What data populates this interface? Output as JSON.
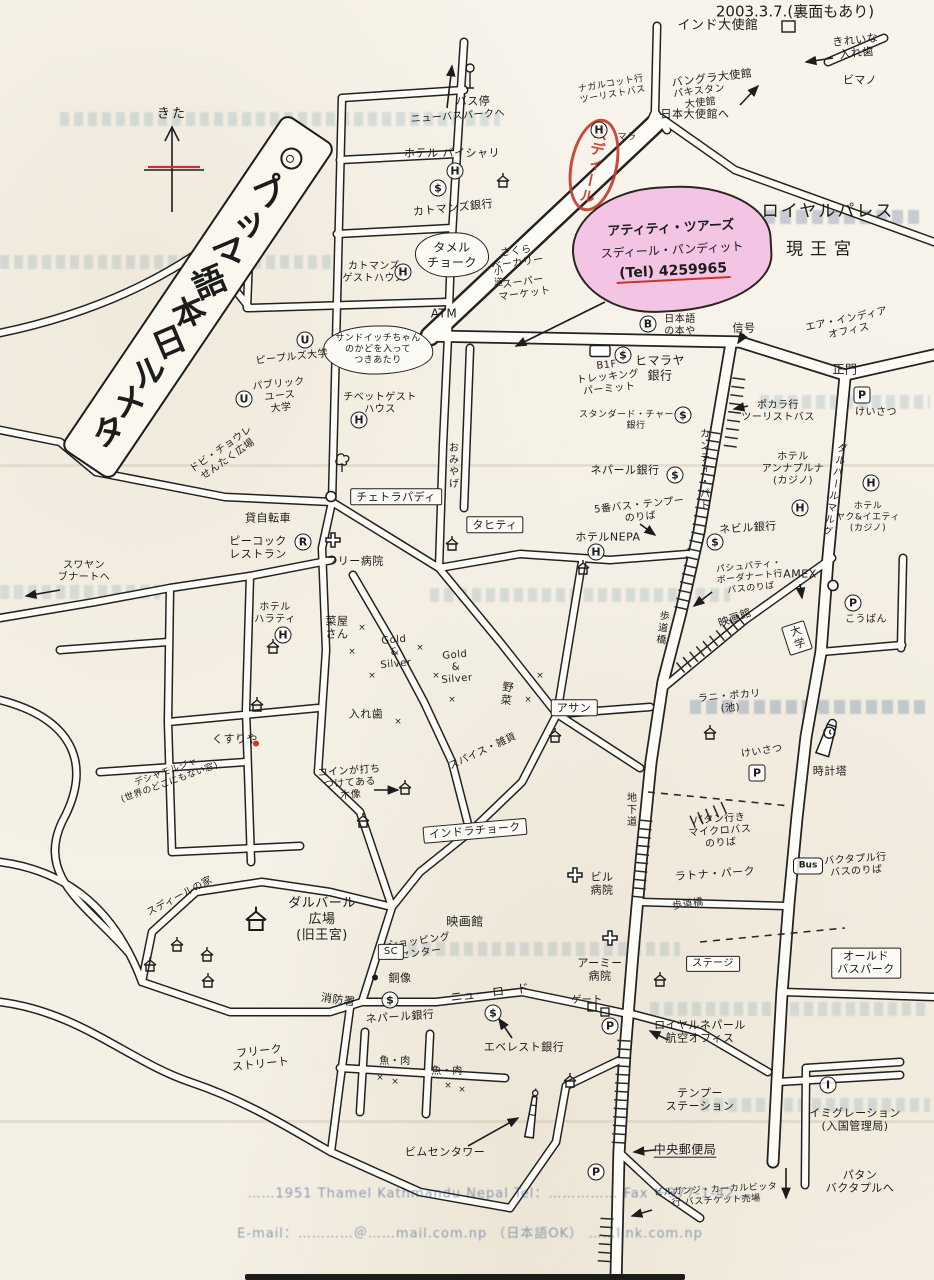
{
  "title": "タメル日本語マップ",
  "date_note": "2003.3.7.(裏面もあり)",
  "compass": {
    "label": "きた"
  },
  "stamp": {
    "text": "スディール",
    "color": "#c5372c"
  },
  "tour_office": {
    "name": "アティティ・ツアーズ",
    "person": "スディール・パンディット",
    "tel": "(Tel) 4259965",
    "highlight": "#f3c4e3"
  },
  "palace": {
    "name": "ロイヤルパレス",
    "subtitle": "現王宮"
  },
  "footer": {
    "line1": "……1951 Thamel Kathmandu Nepal  Tel：……………  Fax ＋977-1-42……",
    "line2": "E-mail：…………＠……mail.com.np （日本語OK） ……link.com.np"
  },
  "colors": {
    "ink": "#1c1c1c",
    "paper": "#f8f4ec",
    "pink": "#f3c4e3",
    "red": "#c5372c",
    "bleed": "#488096"
  },
  "legend_badges": {
    "H": "ホテル",
    "$": "銀行",
    "U": "大学",
    "B": "本や",
    "R": "レストラン",
    "P": "けいさつ",
    "I": "イミグレーション",
    "Bus": "バスのりば"
  },
  "labels": [
    {
      "t": "インド大使館",
      "x": 718,
      "y": 26,
      "s": 13
    },
    {
      "t": "きれいな\n入れ歯",
      "x": 856,
      "y": 47,
      "s": 11,
      "r": -6
    },
    {
      "t": "ビマノ",
      "x": 860,
      "y": 80,
      "s": 11
    },
    {
      "t": "バングラ大使館",
      "x": 712,
      "y": 78,
      "s": 11,
      "r": -7
    },
    {
      "t": "パキスタン\n大使館",
      "x": 700,
      "y": 98,
      "s": 10,
      "r": -7
    },
    {
      "t": "日本大使館へ",
      "x": 695,
      "y": 114,
      "s": 11
    },
    {
      "t": "ナガルコット行\nツーリストバス",
      "x": 612,
      "y": 90,
      "s": 9,
      "r": -10
    },
    {
      "t": "バス停",
      "x": 473,
      "y": 101,
      "s": 11
    },
    {
      "t": "ニューバスパークへ",
      "x": 458,
      "y": 117,
      "s": 10,
      "r": -4
    },
    {
      "t": "ホテル バイシャリ",
      "x": 452,
      "y": 153,
      "s": 11
    },
    {
      "t": "マラ",
      "x": 627,
      "y": 138,
      "s": 9
    },
    {
      "t": "カトマンズ銀行",
      "x": 453,
      "y": 208,
      "s": 11,
      "r": -6
    },
    {
      "t": "タメル\nチョーク",
      "x": 452,
      "y": 255,
      "s": 12,
      "cloud": true
    },
    {
      "t": "カトマンズ\nゲストハウス",
      "x": 374,
      "y": 273,
      "s": 10
    },
    {
      "t": "さくら\nベーカリー",
      "x": 517,
      "y": 258,
      "s": 10,
      "r": -8
    },
    {
      "t": "小道",
      "x": 496,
      "y": 277,
      "s": 9,
      "v": true
    },
    {
      "t": "スーパー\nマーケット",
      "x": 524,
      "y": 289,
      "s": 10,
      "r": -8
    },
    {
      "t": "ATM",
      "x": 444,
      "y": 314,
      "s": 12
    },
    {
      "t": "サンドイッチちゃん\nのかどを入って\nつきあたり",
      "x": 378,
      "y": 350,
      "s": 9,
      "cloud": true
    },
    {
      "t": "ピープルズ大学",
      "x": 292,
      "y": 358,
      "s": 10,
      "r": -6
    },
    {
      "t": "パブリック\nユース\n大学",
      "x": 280,
      "y": 397,
      "s": 10,
      "r": -6
    },
    {
      "t": "チベットゲスト\nハウス",
      "x": 380,
      "y": 404,
      "s": 10
    },
    {
      "t": "ドビ・チョウレ\nせんたく広場",
      "x": 225,
      "y": 455,
      "s": 10,
      "r": -35
    },
    {
      "t": "B1F\nトレッキング\nパーミット",
      "x": 608,
      "y": 378,
      "s": 10,
      "r": -6
    },
    {
      "t": "ヒマラヤ\n銀行",
      "x": 660,
      "y": 368,
      "s": 12
    },
    {
      "t": "スタンダード・チャーター\n銀行",
      "x": 636,
      "y": 421,
      "s": 9
    },
    {
      "t": "ポカラ行\nツーリストバス",
      "x": 778,
      "y": 412,
      "s": 10
    },
    {
      "t": "ネパール銀行",
      "x": 625,
      "y": 470,
      "s": 11
    },
    {
      "t": "日本語\nの本や",
      "x": 680,
      "y": 326,
      "s": 10
    },
    {
      "t": "信号",
      "x": 744,
      "y": 328,
      "s": 11
    },
    {
      "t": "エア・インディア\nオフィス",
      "x": 848,
      "y": 326,
      "s": 10,
      "r": -12
    },
    {
      "t": "正門",
      "x": 845,
      "y": 370,
      "s": 12
    },
    {
      "t": "けいさつ",
      "x": 876,
      "y": 413,
      "s": 10
    },
    {
      "t": "カンティ・パト",
      "x": 703,
      "y": 470,
      "s": 10,
      "v": true
    },
    {
      "t": "ホテル\nアンナプルナ\n(カジノ)",
      "x": 793,
      "y": 470,
      "s": 10
    },
    {
      "t": "ホテル\nヤク&イエティ\n(カジノ)",
      "x": 868,
      "y": 518,
      "s": 9
    },
    {
      "t": "ダルバールマルグ",
      "x": 833,
      "y": 490,
      "s": 10,
      "v": true,
      "r": 10
    },
    {
      "t": "おみやげ",
      "x": 452,
      "y": 466,
      "s": 10,
      "v": true
    },
    {
      "t": "チェトラパディ",
      "x": 396,
      "y": 497,
      "s": 11,
      "box": true
    },
    {
      "t": "貸自転車",
      "x": 268,
      "y": 518,
      "s": 11
    },
    {
      "t": "ピーコック\nレストラン",
      "x": 258,
      "y": 548,
      "s": 11
    },
    {
      "t": "フリー病院",
      "x": 355,
      "y": 561,
      "s": 11
    },
    {
      "t": "タヒティ",
      "x": 495,
      "y": 525,
      "s": 11,
      "box": true
    },
    {
      "t": "5番バス・テンプー\nのりば",
      "x": 640,
      "y": 512,
      "s": 10,
      "r": -6
    },
    {
      "t": "ホテルNEPA",
      "x": 608,
      "y": 537,
      "s": 11
    },
    {
      "t": "ネビル銀行",
      "x": 748,
      "y": 528,
      "s": 11,
      "r": -4
    },
    {
      "t": "パシュパティ・\nボーダナート行\nバスのりば",
      "x": 750,
      "y": 578,
      "s": 9,
      "r": -6
    },
    {
      "t": "AMEX",
      "x": 800,
      "y": 574,
      "s": 11
    },
    {
      "t": "映画館",
      "x": 735,
      "y": 618,
      "s": 11,
      "r": -20
    },
    {
      "t": "歩道橋",
      "x": 661,
      "y": 628,
      "s": 10,
      "v": true,
      "r": 8
    },
    {
      "t": "大学",
      "x": 797,
      "y": 638,
      "s": 11,
      "v": true,
      "box": true,
      "r": -18
    },
    {
      "t": "こうばん",
      "x": 866,
      "y": 620,
      "s": 10
    },
    {
      "t": "スワヤン\nブナートへ",
      "x": 84,
      "y": 572,
      "s": 10
    },
    {
      "t": "ホテル\nハラティ",
      "x": 275,
      "y": 614,
      "s": 10
    },
    {
      "t": "菜屋\nさん",
      "x": 337,
      "y": 628,
      "s": 11
    },
    {
      "t": "Gold\n&\nSilver",
      "x": 395,
      "y": 653,
      "s": 10,
      "r": -5
    },
    {
      "t": "Gold\n&\nSilver",
      "x": 456,
      "y": 668,
      "s": 10,
      "r": -5
    },
    {
      "t": "野菜",
      "x": 506,
      "y": 694,
      "s": 11,
      "v": true,
      "r": 8
    },
    {
      "t": "アサン",
      "x": 574,
      "y": 708,
      "s": 11,
      "box": true
    },
    {
      "t": "入れ歯",
      "x": 366,
      "y": 714,
      "s": 11
    },
    {
      "t": "くすりや",
      "x": 235,
      "y": 739,
      "s": 11
    },
    {
      "t": "デシャモルジャ\n(世界のどこにもない窓)",
      "x": 168,
      "y": 778,
      "s": 9,
      "r": -20
    },
    {
      "t": "コインが打ち\nつけてある\n木像",
      "x": 350,
      "y": 784,
      "s": 10,
      "r": -4
    },
    {
      "t": "スパイス・雑貨",
      "x": 483,
      "y": 752,
      "s": 10,
      "r": -25
    },
    {
      "t": "インドラチョーク",
      "x": 475,
      "y": 831,
      "s": 11,
      "box": true,
      "r": -5
    },
    {
      "t": "地下道",
      "x": 630,
      "y": 810,
      "s": 10,
      "v": true
    },
    {
      "t": "ラニ・ポカリ\n(池)",
      "x": 730,
      "y": 703,
      "s": 10,
      "r": -5
    },
    {
      "t": "けいさつ",
      "x": 762,
      "y": 752,
      "s": 10,
      "r": -8
    },
    {
      "t": "時計塔",
      "x": 830,
      "y": 771,
      "s": 11
    },
    {
      "t": "パタン行き\nマイクロバス\nのりば",
      "x": 720,
      "y": 832,
      "s": 10,
      "r": -4
    },
    {
      "t": "バクタプル行\nバスのりば",
      "x": 856,
      "y": 866,
      "s": 10,
      "r": -4
    },
    {
      "t": "ラトナ・パーク",
      "x": 715,
      "y": 874,
      "s": 11,
      "r": -4
    },
    {
      "t": "歩道橋",
      "x": 688,
      "y": 905,
      "s": 10,
      "r": -8
    },
    {
      "t": "ビル\n病院",
      "x": 602,
      "y": 884,
      "s": 11
    },
    {
      "t": "アーミー\n病院",
      "x": 600,
      "y": 970,
      "s": 11
    },
    {
      "t": "ステージ",
      "x": 713,
      "y": 964,
      "s": 10,
      "box": true
    },
    {
      "t": "ゲート",
      "x": 587,
      "y": 1001,
      "s": 10
    },
    {
      "t": "ロイヤルネパール\n航空オフィス",
      "x": 700,
      "y": 1032,
      "s": 11
    },
    {
      "t": "オールド\nバスパーク",
      "x": 866,
      "y": 963,
      "s": 11,
      "box": true
    },
    {
      "t": "テンプー\nステーション",
      "x": 700,
      "y": 1100,
      "s": 11
    },
    {
      "t": "中央郵便局",
      "x": 685,
      "y": 1150,
      "s": 12,
      "u": true
    },
    {
      "t": "イミグレーション\n(入国管理局)",
      "x": 855,
      "y": 1120,
      "s": 11
    },
    {
      "t": "パタン\nバクタプルへ",
      "x": 860,
      "y": 1182,
      "s": 11
    },
    {
      "t": "ビルガンジ・カーカルビッタ\n行 バスチケット売場",
      "x": 716,
      "y": 1196,
      "s": 9,
      "r": -3
    },
    {
      "t": "ビムセンタワー",
      "x": 445,
      "y": 1152,
      "s": 11
    },
    {
      "t": "魚・肉",
      "x": 395,
      "y": 1062,
      "s": 10
    },
    {
      "t": "魚・肉",
      "x": 447,
      "y": 1072,
      "s": 10
    },
    {
      "t": "エベレスト銀行",
      "x": 524,
      "y": 1047,
      "s": 11
    },
    {
      "t": "ニュー ロード",
      "x": 490,
      "y": 993,
      "s": 12,
      "r": -7
    },
    {
      "t": "銅像",
      "x": 400,
      "y": 978,
      "s": 11
    },
    {
      "t": "ネパール銀行",
      "x": 400,
      "y": 1017,
      "s": 11,
      "r": -4
    },
    {
      "t": "ショッピング\nセンター",
      "x": 420,
      "y": 948,
      "s": 10,
      "r": -8
    },
    {
      "t": "SC",
      "x": 391,
      "y": 952,
      "s": 10,
      "box": true
    },
    {
      "t": "映画館",
      "x": 465,
      "y": 922,
      "s": 12
    },
    {
      "t": "消防署",
      "x": 338,
      "y": 1000,
      "s": 11,
      "r": 8
    },
    {
      "t": "フリーク\nストリート",
      "x": 260,
      "y": 1058,
      "s": 11,
      "r": -6
    },
    {
      "t": "ダルバール\n広場\n(旧王宮)",
      "x": 322,
      "y": 920,
      "s": 13
    },
    {
      "t": "スディールの家",
      "x": 180,
      "y": 897,
      "s": 10,
      "r": -28
    }
  ],
  "symbols": [
    {
      "k": "H",
      "x": 455,
      "y": 171
    },
    {
      "k": "H",
      "x": 599,
      "y": 130
    },
    {
      "k": "H",
      "x": 403,
      "y": 272
    },
    {
      "k": "H",
      "x": 359,
      "y": 420
    },
    {
      "k": "H",
      "x": 283,
      "y": 635
    },
    {
      "k": "H",
      "x": 596,
      "y": 552
    },
    {
      "k": "H",
      "x": 800,
      "y": 508
    },
    {
      "k": "H",
      "x": 871,
      "y": 483
    },
    {
      "k": "S",
      "x": 438,
      "y": 188
    },
    {
      "k": "S",
      "x": 623,
      "y": 355
    },
    {
      "k": "S",
      "x": 683,
      "y": 415
    },
    {
      "k": "S",
      "x": 675,
      "y": 475
    },
    {
      "k": "S",
      "x": 715,
      "y": 542
    },
    {
      "k": "S",
      "x": 390,
      "y": 1000
    },
    {
      "k": "S",
      "x": 493,
      "y": 1013
    },
    {
      "k": "U",
      "x": 305,
      "y": 340
    },
    {
      "k": "U",
      "x": 244,
      "y": 399
    },
    {
      "k": "B",
      "x": 648,
      "y": 324
    },
    {
      "k": "R",
      "x": 303,
      "y": 542
    },
    {
      "k": "P",
      "x": 853,
      "y": 603
    },
    {
      "k": "P",
      "x": 596,
      "y": 1172
    },
    {
      "k": "P",
      "x": 610,
      "y": 1026
    },
    {
      "k": "PSQ",
      "x": 862,
      "y": 395
    },
    {
      "k": "PSQ",
      "x": 757,
      "y": 773
    },
    {
      "k": "I",
      "x": 828,
      "y": 1085
    },
    {
      "k": "BUS",
      "x": 808,
      "y": 866
    },
    {
      "k": "CROSS",
      "x": 333,
      "y": 542
    },
    {
      "k": "CROSS",
      "x": 575,
      "y": 877
    },
    {
      "k": "CROSS",
      "x": 610,
      "y": 940
    },
    {
      "k": "TEMPLE",
      "x": 503,
      "y": 183
    },
    {
      "k": "TEMPLE",
      "x": 452,
      "y": 546
    },
    {
      "k": "TEMPLE",
      "x": 583,
      "y": 570
    },
    {
      "k": "TEMPLE",
      "x": 555,
      "y": 738
    },
    {
      "k": "TEMPLE",
      "x": 257,
      "y": 707
    },
    {
      "k": "TEMPLE",
      "x": 363,
      "y": 823
    },
    {
      "k": "TEMPLE",
      "x": 405,
      "y": 790
    },
    {
      "k": "TEMPLE",
      "x": 177,
      "y": 947
    },
    {
      "k": "TEMPLE",
      "x": 150,
      "y": 967
    },
    {
      "k": "TEMPLE",
      "x": 207,
      "y": 957
    },
    {
      "k": "TEMPLE",
      "x": 208,
      "y": 983
    },
    {
      "k": "TEMPLE",
      "x": 660,
      "y": 982
    },
    {
      "k": "TEMPLE",
      "x": 570,
      "y": 1083
    },
    {
      "k": "TEMPLE",
      "x": 273,
      "y": 649
    },
    {
      "k": "TEMPLE",
      "x": 710,
      "y": 735
    },
    {
      "k": "TEMPLE_BIG",
      "x": 256,
      "y": 922
    },
    {
      "k": "TREE",
      "x": 342,
      "y": 464
    },
    {
      "k": "RING",
      "x": 331,
      "y": 498
    },
    {
      "k": "RING",
      "x": 833,
      "y": 587
    },
    {
      "k": "DOT",
      "x": 375,
      "y": 976
    },
    {
      "k": "DOT_RED",
      "x": 256,
      "y": 742
    },
    {
      "k": "CLOCK",
      "x": 827,
      "y": 742
    },
    {
      "k": "TOWER",
      "x": 532,
      "y": 1118
    },
    {
      "k": "KIOSK",
      "x": 600,
      "y": 352
    },
    {
      "k": "BUSSTOP",
      "x": 470,
      "y": 78
    },
    {
      "k": "X",
      "x": 362,
      "y": 628
    },
    {
      "k": "X",
      "x": 352,
      "y": 652
    },
    {
      "k": "X",
      "x": 372,
      "y": 676
    },
    {
      "k": "X",
      "x": 420,
      "y": 648
    },
    {
      "k": "X",
      "x": 436,
      "y": 676
    },
    {
      "k": "X",
      "x": 452,
      "y": 700
    },
    {
      "k": "X",
      "x": 540,
      "y": 676
    },
    {
      "k": "X",
      "x": 528,
      "y": 700
    },
    {
      "k": "X",
      "x": 398,
      "y": 722
    },
    {
      "k": "X",
      "x": 380,
      "y": 1078
    },
    {
      "k": "X",
      "x": 395,
      "y": 1082
    },
    {
      "k": "X",
      "x": 448,
      "y": 1086
    },
    {
      "k": "X",
      "x": 462,
      "y": 1090
    }
  ]
}
